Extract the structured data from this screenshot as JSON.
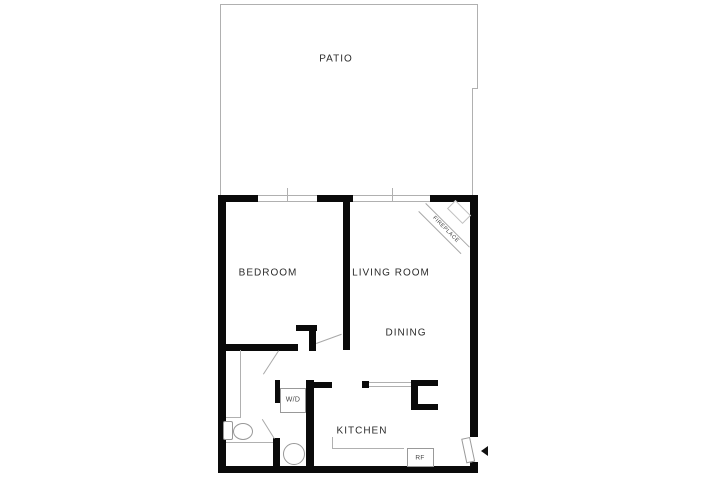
{
  "plan_title": "one-bedroom-apartment-floor-plan",
  "rooms": {
    "patio": "PATIO",
    "bedroom": "BEDROOM",
    "living_room": "LIVING ROOM",
    "dining": "DINING",
    "kitchen": "KITCHEN"
  },
  "fixtures": {
    "washer_dryer": "W/D",
    "refrigerator": "RF",
    "fireplace": "FIREPLACE"
  },
  "colors": {
    "wall": "#0a0a0a",
    "thin_line": "#b0b0b0",
    "text": "#2b2b2b",
    "background": "#ffffff"
  }
}
